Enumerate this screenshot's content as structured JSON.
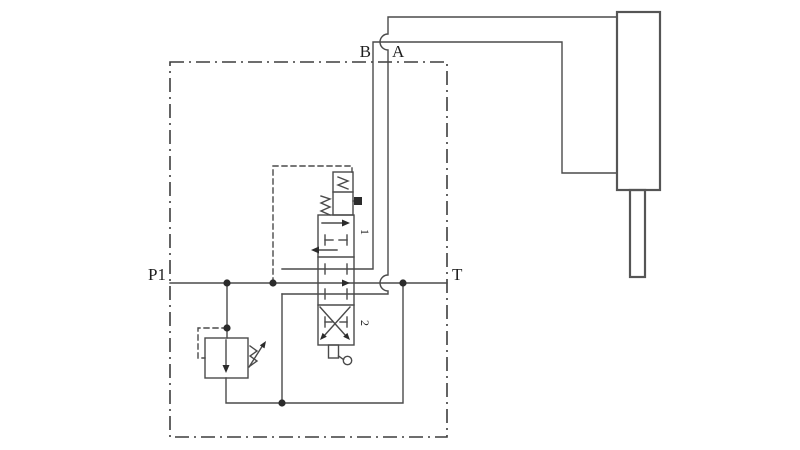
{
  "labels": {
    "p1": "P1",
    "t": "T",
    "b": "B",
    "a": "A",
    "pos1": "1",
    "pos2": "2"
  },
  "components": [
    {
      "name": "system-boundary",
      "type": "dash-dot-enclosure"
    },
    {
      "name": "pressure-line-p1",
      "type": "solid-line"
    },
    {
      "name": "tank-return-line",
      "type": "solid-line"
    },
    {
      "name": "work-line-a",
      "type": "solid-line-with-crossover-hops"
    },
    {
      "name": "work-line-b",
      "type": "solid-line"
    },
    {
      "name": "relief-valve",
      "type": "adjustable-pressure-relief-valve"
    },
    {
      "name": "relief-pilot-line",
      "type": "dashed-line"
    },
    {
      "name": "directional-control-valve",
      "type": "3-position-monoblock-spool"
    },
    {
      "name": "valve-pilot-section",
      "type": "detent-box-with-plug"
    },
    {
      "name": "valve-return-spring",
      "type": "spring"
    },
    {
      "name": "valve-lever",
      "type": "manual-operator"
    },
    {
      "name": "hydraulic-cylinder",
      "type": "single-rod-cylinder"
    }
  ],
  "colors": {
    "line": "#4a4a4a",
    "boundary": "#3d3d3d",
    "cylinder": "#555555",
    "ink": "#2b2b2b",
    "background": "#ffffff"
  }
}
